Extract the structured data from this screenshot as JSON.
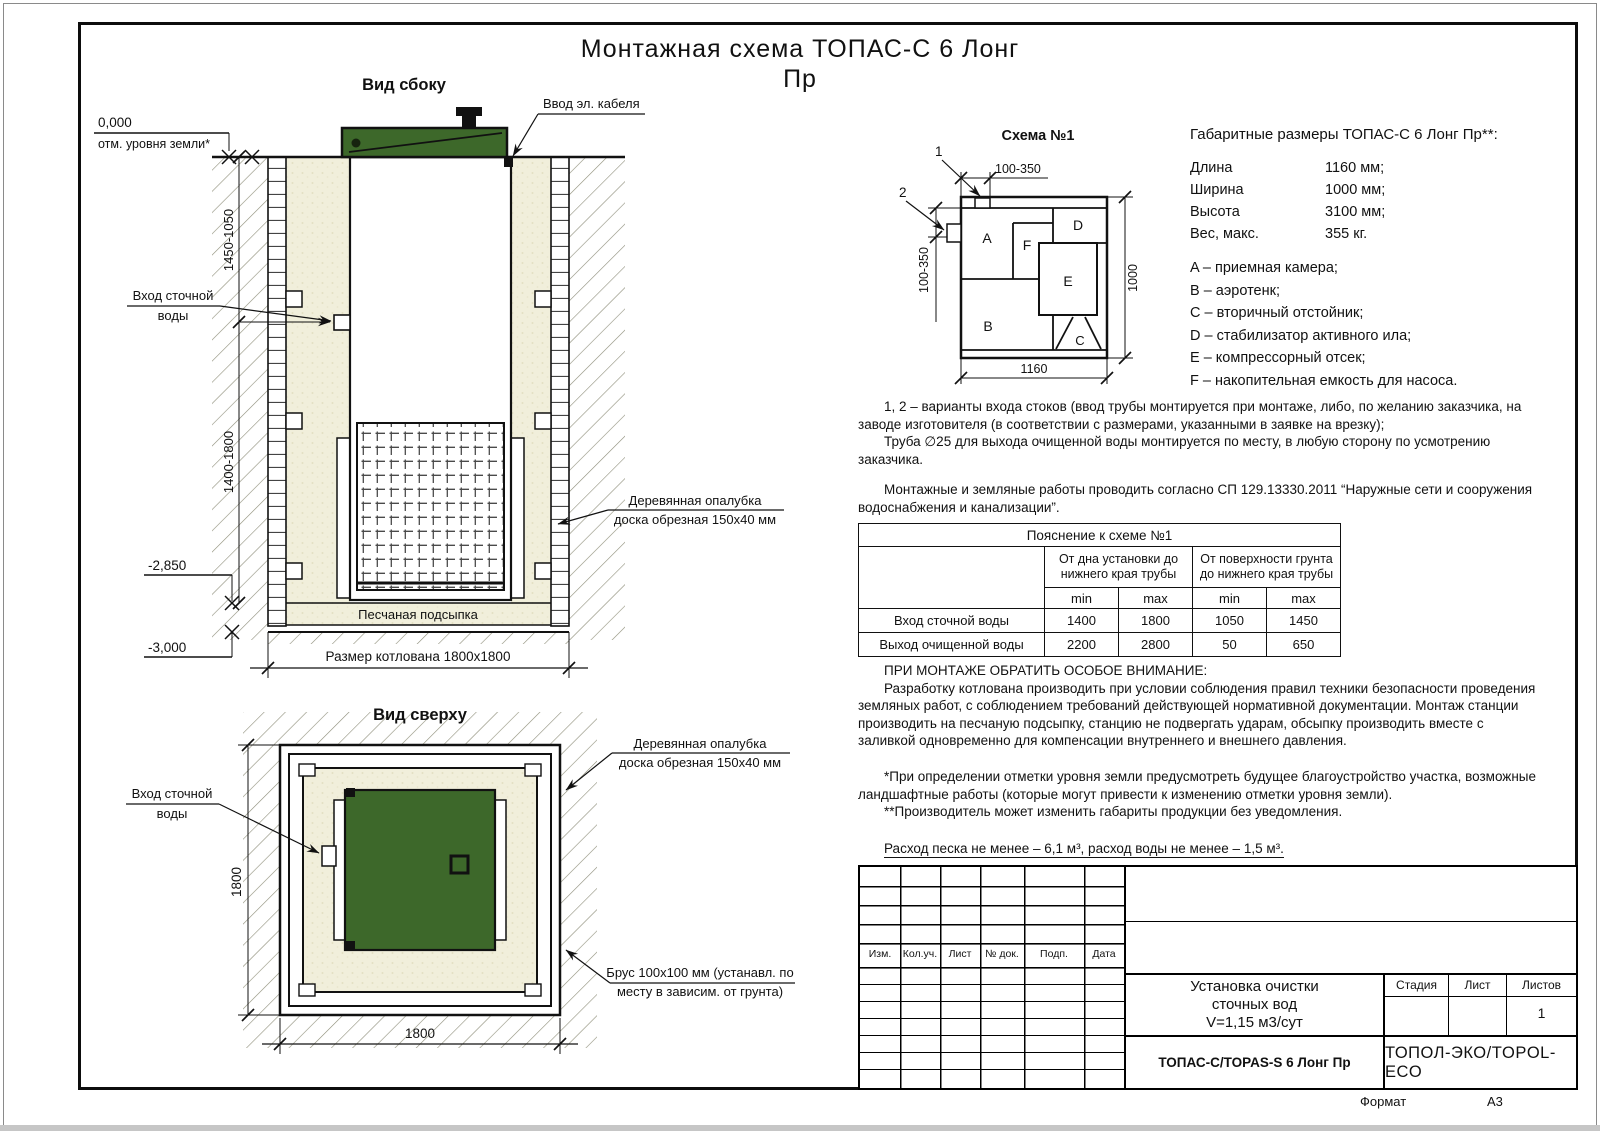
{
  "title": {
    "line1": "Монтажная схема ТОПАС-С 6 Лонг",
    "line2": "Пр"
  },
  "colors": {
    "lid_green": "#3d682a",
    "sand": "#f1efdb",
    "line": "#111111"
  },
  "side_view": {
    "caption": "Вид сбоку",
    "cable_label": "Ввод эл. кабеля",
    "zero_mark": "0,000",
    "ground_label": "отм. уровня земли*",
    "dim_upper": "1450-1050",
    "dim_lower": "1400-1800",
    "inlet_line1": "Вход сточной",
    "inlet_line2": "воды",
    "elev1": "-2,850",
    "elev2": "-3,000",
    "sand_label": "Песчаная подсыпка",
    "pit_label": "Размер котлована 1800х1800",
    "formwork_line1": "Деревянная опалубка",
    "formwork_line2": "доска обрезная 150х40 мм"
  },
  "top_view": {
    "caption": "Вид сверху",
    "inlet_line1": "Вход сточной",
    "inlet_line2": "воды",
    "dim_left": "1800",
    "dim_bottom": "1800",
    "formwork_line1": "Деревянная опалубка",
    "formwork_line2": "доска обрезная 150х40 мм",
    "beam_line1": "Брус 100х100 мм (устанавл. по",
    "beam_line2": "месту в зависим. от грунта)"
  },
  "schema": {
    "caption": "Схема №1",
    "callout1": "1",
    "callout2": "2",
    "dim_top": "100-350",
    "dim_left": "100-350",
    "dim_bottom": "1160",
    "dim_right": "1000",
    "comp_a": "A",
    "comp_b": "B",
    "comp_c": "C",
    "comp_d": "D",
    "comp_e": "E",
    "comp_f": "F"
  },
  "specs": {
    "heading": "Габаритные размеры ТОПАС-С 6 Лонг Пр**:",
    "rows": [
      {
        "label": "Длина",
        "value": "1160 мм;"
      },
      {
        "label": "Ширина",
        "value": "1000 мм;"
      },
      {
        "label": "Высота",
        "value": "3100 мм;"
      },
      {
        "label": "Вес, макс.",
        "value": "355 кг."
      }
    ],
    "legend": [
      "A – приемная камера;",
      "B – аэротенк;",
      "C – вторичный отстойник;",
      "D – стабилизатор активного ила;",
      "E – компрессорный отсек;",
      "F – накопительная емкость для насоса."
    ]
  },
  "notes": {
    "p1": "1, 2 – варианты входа стоков (ввод трубы монтируется при монтаже, либо, по желанию заказчика, на заводе изготовителя (в соответствии с размерами, указанными в заявке на врезку);",
    "p2": "Труба ∅25 для выхода очищенной воды монтируется по месту, в любую сторону по усмотрению заказчика.",
    "p3": "Монтажные и земляные работы проводить согласно СП 129.13330.2011 “Наружные сети и сооружения водоснабжения и канализации”."
  },
  "table": {
    "title": "Пояснение к схеме №1",
    "group1": "От дна установки до нижнего края трубы",
    "group2": "От поверхности грунта до нижнего края трубы",
    "min": "min",
    "max": "max",
    "rows": [
      {
        "label": "Вход сточной воды",
        "c1": "1400",
        "c2": "1800",
        "c3": "1050",
        "c4": "1450"
      },
      {
        "label": "Выход очищенной воды",
        "c1": "2200",
        "c2": "2800",
        "c3": "50",
        "c4": "650"
      }
    ]
  },
  "attention": {
    "heading": "ПРИ МОНТАЖЕ ОБРАТИТЬ ОСОБОЕ ВНИМАНИЕ:",
    "body": "Разработку котлована производить при условии соблюдения правил техники безопасности проведения земляных работ, с соблюдением требований действующей нормативной документации. Монтаж станции производить на песчаную подсыпку, станцию не подвергать ударам, обсыпку производить вместе с заливкой одновременно для компенсации внутреннего и внешнего давления."
  },
  "footnotes": {
    "f1": "*При определении отметки уровня земли предусмотреть будущее благоустройство участка, возможные ландшафтные работы (которые могут привести к изменению отметки уровня земли).",
    "f2": "**Производитель может изменить габариты продукции без уведомления."
  },
  "consumption": "Расход песка не менее – 6,1 м³, расход воды не менее – 1,5 м³.",
  "stamp": {
    "col_izm": "Изм.",
    "col_kol": "Кол.уч.",
    "col_list": "Лист",
    "col_ndok": "№ док.",
    "col_podp": "Подп.",
    "col_data": "Дата",
    "name1": "Установка очистки",
    "name2": "сточных вод",
    "name3": "V=1,15 м3/сут",
    "stage": "Стадия",
    "sheet": "Лист",
    "sheets": "Листов",
    "sheets_value": "1",
    "doc": "ТОПАС-С/TOPAS-S 6 Лонг Пр",
    "org": "ТОПОЛ-ЭКО/TOPOL-ECO",
    "format_label": "Формат",
    "format_value": "А3"
  }
}
